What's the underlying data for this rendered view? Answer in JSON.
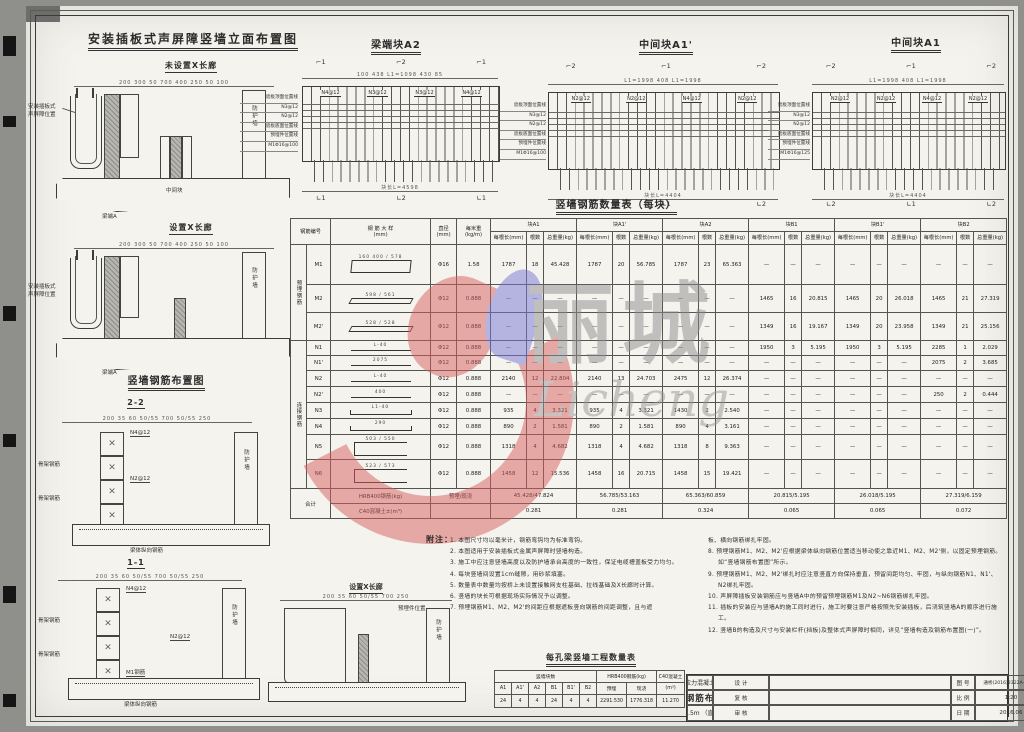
{
  "labels": {
    "guard_wall": "防护墙",
    "sb1": "安装插板式",
    "sb2": "声屏障位置",
    "beam_end": "梁端A",
    "mid_block": "中间块",
    "deck_rebar": "梁体纵向钢筋",
    "skeleton1": "骨架钢筋",
    "skeleton2": "骨架钢筋",
    "m1bar": "M1钢筋",
    "n2tag": "N2@12",
    "n4tag": "N4@12",
    "embed_tag": "预埋件位置"
  },
  "titles": {
    "elev": "安装插板式声屏障竖墙立面布置图",
    "no_corridor": "未设置X长廊",
    "with_corridor": "设置X长廊",
    "rebar_layout": "竖墙钢筋布置图",
    "sec22": "2-2",
    "sec11": "1-1",
    "corridor_sec": "设置X长廊",
    "rebar_table": "竖墙钢筋数量表（每块）",
    "qty_table": "每孔梁竖墙工程数量表",
    "notes": "附注："
  },
  "elev": {
    "dims1": "200  300 50        700        400   250  50 100",
    "dims2": "200  300 50        700        400   250  50 100"
  },
  "sections": {
    "dims22": "200  35 60 50/55      700      50/55  250",
    "dims11": "200  35 60 50/55      700      50/55  250",
    "dimsX": "200  35 60 50/55    700    250"
  },
  "gridA2": {
    "title": "梁端块A2",
    "top_dims": "100    438    L1=1098    430    85",
    "band": [
      "N4@12",
      "N3@12",
      "N3@12",
      "N4@12"
    ],
    "bottom": "块长L=4598",
    "marks_top": [
      "⌐1",
      "⌐2",
      "⌐1"
    ],
    "marks_bottom": [
      "∟1",
      "∟2",
      "∟1"
    ],
    "stack": [
      "遮板顶面位置线",
      "N3@12",
      "N2@12",
      "遮板底面位置线",
      "预埋件位置线",
      "M1Φ16@100"
    ]
  },
  "gridA1p": {
    "title": "中间块A1'",
    "top_dims": "L1=1998      408      L1=1998",
    "band": [
      "N2@12",
      "N2@12",
      "N4@12",
      "N2@12"
    ],
    "bottom": "块长L=4404",
    "marks_top": [
      "⌐2",
      "⌐1",
      "⌐2"
    ],
    "marks_bottom": [
      "∟2",
      "∟1",
      "∟2"
    ],
    "stack": [
      "遮板顶面位置线",
      "N3@12",
      "N2@12",
      "遮板底面位置线",
      "预埋件位置线",
      "M1Φ16@100"
    ]
  },
  "gridA1": {
    "title": "中间块A1",
    "top_dims": "L1=1998    408    L1=1998",
    "band": [
      "N2@12",
      "N2@12",
      "N4@12",
      "N2@12"
    ],
    "bottom": "块长L=4404",
    "marks_top": [
      "⌐2",
      "⌐1",
      "⌐2"
    ],
    "marks_bottom": [
      "∟2",
      "∟1",
      "∟2"
    ],
    "stack": [
      "遮板顶面位置线",
      "N3@12",
      "N2@12",
      "遮板底面位置线",
      "预埋件位置线",
      "M1Φ16@125"
    ]
  },
  "rebar_table": {
    "dash": "—",
    "col_id": "钢筋编号",
    "col_shape": "钢 筋 大 样\n(mm)",
    "col_dia": "直径\n(mm)",
    "col_wt": "每米重\n(kg/m)",
    "sub": [
      "每根长(mm)",
      "根数",
      "总重量(kg)"
    ],
    "blocks": [
      "块A1",
      "块A1'",
      "块A2",
      "块B1",
      "块B1'",
      "块B2"
    ],
    "groups": [
      {
        "name": "预埋钢筋",
        "rows": [
          {
            "id": "M1",
            "shape": "rect",
            "dims": "160  400 / 578",
            "dia": "Φ16",
            "wt": "1.58",
            "cells": [
              [
                "1787",
                "18",
                "45.428"
              ],
              [
                "1787",
                "20",
                "56.785"
              ],
              [
                "1787",
                "23",
                "65.363"
              ],
              null,
              null,
              null
            ]
          },
          {
            "id": "M2",
            "shape": "flat",
            "dims": "598 / 561",
            "dia": "Φ12",
            "wt": "0.888",
            "cells": [
              null,
              null,
              null,
              [
                "1465",
                "16",
                "20.815"
              ],
              [
                "1465",
                "20",
                "26.018"
              ],
              [
                "1465",
                "21",
                "27.319"
              ]
            ]
          },
          {
            "id": "M2'",
            "shape": "flat",
            "dims": "528 / 528",
            "dia": "Φ12",
            "wt": "0.888",
            "cells": [
              null,
              null,
              null,
              [
                "1349",
                "16",
                "19.167"
              ],
              [
                "1349",
                "20",
                "23.958"
              ],
              [
                "1349",
                "21",
                "25.156"
              ]
            ]
          }
        ]
      },
      {
        "name": "连接钢筋",
        "rows": [
          {
            "id": "N1",
            "shape": "line",
            "dims": "L-40",
            "dia": "Φ12",
            "wt": "0.888",
            "cells": [
              null,
              null,
              null,
              [
                "1950",
                "3",
                "5.195"
              ],
              [
                "1950",
                "3",
                "5.195"
              ],
              [
                "2285",
                "1",
                "2.029"
              ]
            ]
          },
          {
            "id": "N1'",
            "shape": "line",
            "dims": "2075",
            "dia": "Φ12",
            "wt": "0.888",
            "cells": [
              null,
              null,
              null,
              null,
              null,
              [
                "2075",
                "2",
                "3.685"
              ]
            ]
          },
          {
            "id": "N2",
            "shape": "line",
            "dims": "L-40",
            "dia": "Φ12",
            "wt": "0.888",
            "cells": [
              [
                "2140",
                "12",
                "22.804"
              ],
              [
                "2140",
                "13",
                "24.703"
              ],
              [
                "2475",
                "12",
                "26.374"
              ],
              null,
              null,
              null
            ]
          },
          {
            "id": "N2'",
            "shape": "line",
            "dims": "400",
            "dia": "Φ12",
            "wt": "0.888",
            "cells": [
              null,
              null,
              null,
              null,
              null,
              [
                "250",
                "2",
                "0.444"
              ]
            ]
          },
          {
            "id": "N3",
            "shape": "hook",
            "dims": "L1-40",
            "dia": "Φ12",
            "wt": "0.888",
            "cells": [
              [
                "935",
                "4",
                "3.321"
              ],
              [
                "935",
                "4",
                "3.321"
              ],
              [
                "1430",
                "2",
                "2.540"
              ],
              null,
              null,
              null
            ]
          },
          {
            "id": "N4",
            "shape": "hook",
            "dims": "290",
            "dia": "Φ12",
            "wt": "0.888",
            "cells": [
              [
                "890",
                "2",
                "1.581"
              ],
              [
                "890",
                "2",
                "1.581"
              ],
              [
                "890",
                "4",
                "3.161"
              ],
              null,
              null,
              null
            ]
          },
          {
            "id": "N5",
            "shape": "u",
            "dims": "503 / 550",
            "dia": "Φ12",
            "wt": "0.888",
            "cells": [
              [
                "1318",
                "4",
                "4.682"
              ],
              [
                "1318",
                "4",
                "4.682"
              ],
              [
                "1318",
                "8",
                "9.363"
              ],
              null,
              null,
              null
            ]
          },
          {
            "id": "N6",
            "shape": "u",
            "dims": "523 / 573",
            "dia": "Φ12",
            "wt": "0.888",
            "cells": [
              [
                "1458",
                "12",
                "15.536"
              ],
              [
                "1458",
                "16",
                "20.715"
              ],
              [
                "1458",
                "15",
                "19.421"
              ],
              null,
              null,
              null
            ]
          }
        ]
      }
    ],
    "totals": {
      "label": "合计",
      "steel_label": "HRB400钢筋(kg)",
      "steel_sub": "预埋/现浇",
      "steel": [
        "45.428/47.824",
        "56.785/53.163",
        "65.363/60.859",
        "20.815/5.195",
        "26.018/5.195",
        "27.319/6.159"
      ],
      "conc_label": "C40混凝土±(m³)",
      "conc": [
        "0.281",
        "0.281",
        "0.324",
        "0.065",
        "0.065",
        "0.072"
      ]
    }
  },
  "qty_table": {
    "group1": "竖墙块数",
    "group2": "HRB400钢筋(kg)",
    "group3": "C40混凝土",
    "cols": [
      "A1",
      "A1'",
      "A2",
      "B1",
      "B1'",
      "B2"
    ],
    "steel_cols": [
      "预埋",
      "现浇"
    ],
    "unit": "(m³)",
    "values": [
      "24",
      "4",
      "4",
      "24",
      "4",
      "4"
    ],
    "steel_values": [
      "2291.530",
      "1776.318"
    ],
    "conc_value": "11.270"
  },
  "notes": {
    "left": [
      "1. 本图尺寸均以毫米计，钢筋弯钩均为标准弯钩。",
      "2. 本图适用于安装插板式金属声屏障时竖墙构造。",
      "3. 施工中应注意竖墙高度以及防护墙承台高度的一致性，保证电缆槽盖板受力均匀。",
      "4. 每块竖墙间设置1cm缝隙，用砂浆填塞。",
      "5. 数量表中数量均按桥上未设置接触网支柱基础、拉线基础及X长廊时计算。",
      "6. 竖墙的块长可根据现场实际情况予以调整。",
      "7. 预埋钢筋M1、M2、M2'的间距应根据遮板竖向钢筋的间距调整，且与遮"
    ],
    "right": [
      "板、横向钢筋绑扎牢固。",
      "8. 预埋钢筋M1、M2、M2'应根据梁体纵向钢筋位置适当移动使之靠近M1、M2、M2'侧，以固定预埋钢筋。如“竖墙钢筋布置图”所示。",
      "9. 预埋钢筋M1、M2、M2'绑扎时应注意竖直方向保持垂直，预留间距均匀、牢固，与纵向钢筋N1、N1'、N2绑扎牢固。",
      "10. 声屏障插板安装钢筋应与竖墙A中的预留预埋钢筋M1及N2~N6钢筋绑扎牢固。",
      "11. 插板的安装应与竖墙A的施工同时进行，施工时要注意严格按照先安装插板，后浇筑竖墙A的顺序进行施工。",
      "12. 竖墙B的构造及尺寸与安装栏杆(挡板)及整体式声屏障时相同，详见“竖墙构造及钢筋布置图(一)”。"
    ]
  },
  "titleblock": {
    "r1": "设 计",
    "r2": "复 核",
    "r3": "审 核",
    "line1": "无砟轨道后张法预应力混凝土简支箱梁（双线）",
    "line2": "竖墙构造及钢筋布置图（二）",
    "line3": "跨度：31.5m （直、曲线）",
    "no_label": "图 号",
    "no": "通桥(2016)2322A-Ⅱ-1-22",
    "scale_label": "比 例",
    "scale": "1:20",
    "date_label": "日 期",
    "date": "2016.06"
  },
  "watermark": {
    "cn": "丽城",
    "en": "Licheng"
  }
}
